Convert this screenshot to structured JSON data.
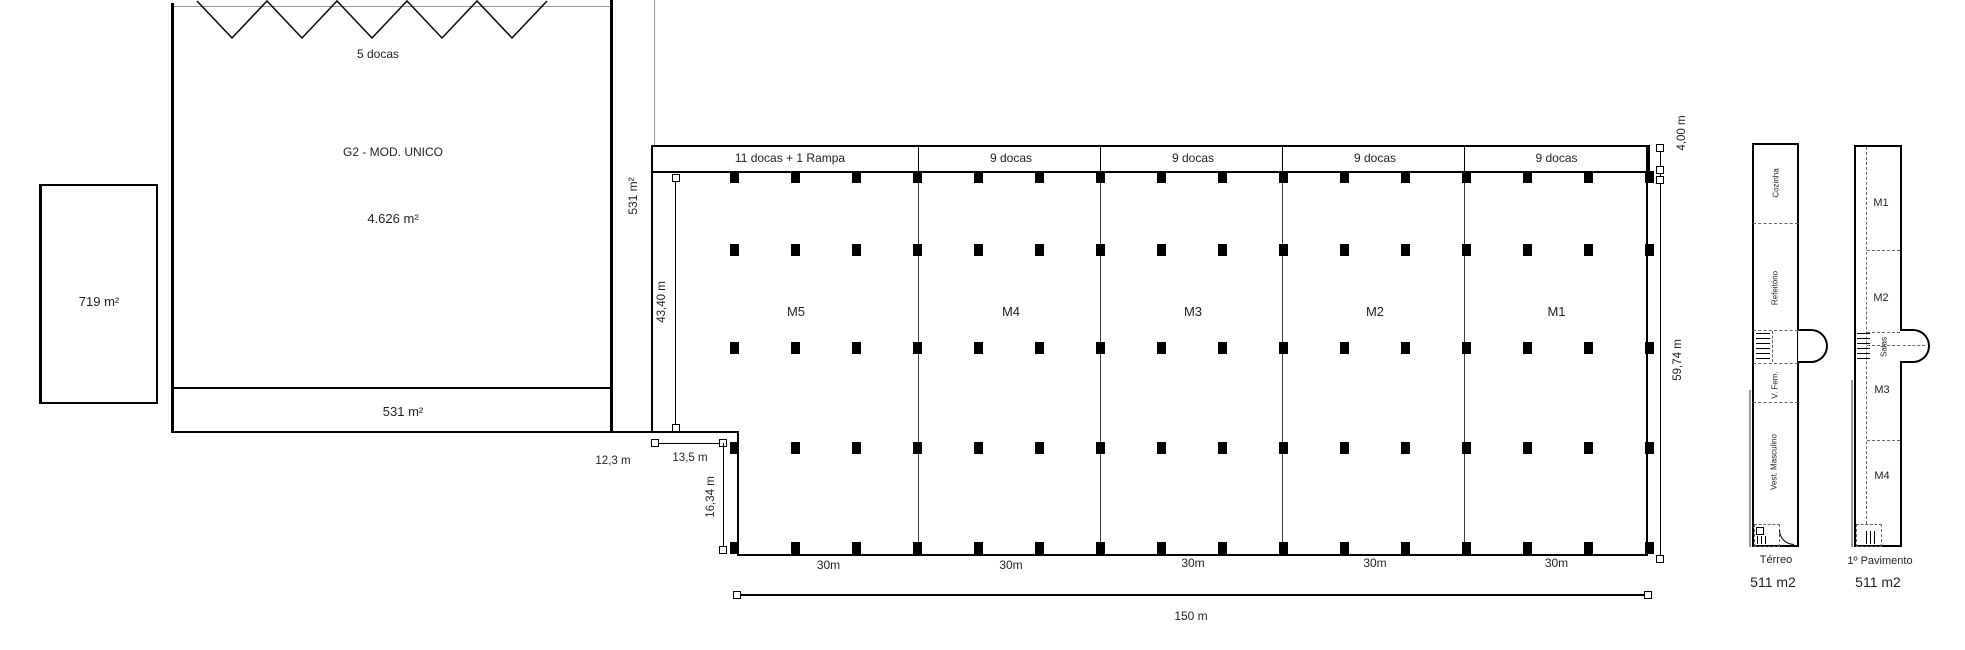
{
  "colors": {
    "ink": "#000000",
    "text": "#1f1f1f"
  },
  "g2": {
    "docks_label": "5 docas",
    "title": "G2 - MOD. UNICO",
    "area": "4.626 m²",
    "strip_area": "531 m²"
  },
  "annex": {
    "area": "719 m²"
  },
  "corridor": {
    "area": "531 m²"
  },
  "warehouse": {
    "modules": [
      {
        "name": "M5",
        "docks": "11 docas + 1 Rampa",
        "width": "30m"
      },
      {
        "name": "M4",
        "docks": "9 docas",
        "width": "30m"
      },
      {
        "name": "M3",
        "docks": "9 docas",
        "width": "30m"
      },
      {
        "name": "M2",
        "docks": "9 docas",
        "width": "30m"
      },
      {
        "name": "M1",
        "docks": "9 docas",
        "width": "30m"
      }
    ],
    "dims": {
      "total_width": "150 m",
      "right_height": "59,74 m",
      "dock_depth": "4,00 m",
      "left_height": "43,40 m",
      "gap": "12,3 m",
      "notch_width": "13,5 m",
      "notch_height": "16,34 m"
    }
  },
  "towers": {
    "ground": {
      "caption": "Térreo",
      "area": "511 m2",
      "rooms": {
        "kitchen": "Cozinha",
        "cafeteria": "Refeitório",
        "female": "V. Fem.",
        "male": "Vest. Masculino"
      }
    },
    "first": {
      "caption": "1º Pavimento",
      "area": "511 m2",
      "rooms": {
        "m1": "M1",
        "m2": "M2",
        "salas": "Salas",
        "m3": "M3",
        "m4": "M4"
      }
    }
  }
}
